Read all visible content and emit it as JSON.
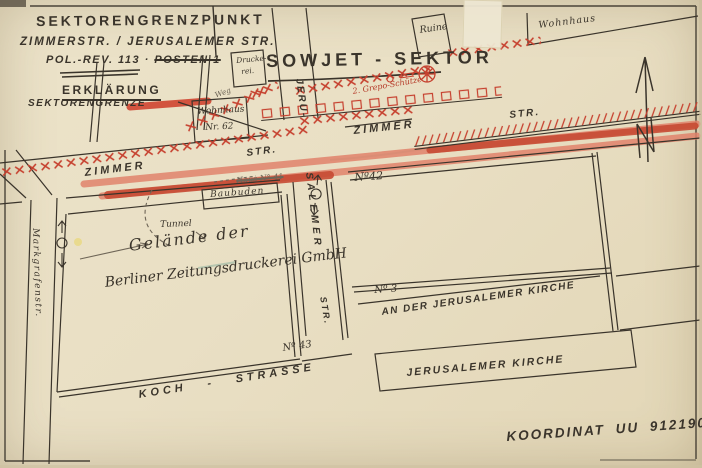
{
  "title": {
    "l1": "SEKTORENGRENZPUNKT",
    "l2": "ZIMMERSTR. / JERUSALEMER STR.",
    "l3a": "POL.-REV. 113 ·",
    "l3b": "POSTEN 1",
    "erklaerung": "ERKLÄRUNG",
    "legend": "SEKTORENGRENZE"
  },
  "banner": {
    "sowjet": "SOWJET - SEKTOR"
  },
  "streets": {
    "zimmer_w": "ZIMMER",
    "str_w": "STR.",
    "zimmer_e": "ZIMMER",
    "str_e": "STR.",
    "jeru": "JERU-",
    "salemer": "SALEMER",
    "str_v": "STR.",
    "markgrafen": "Markgrafenstr.",
    "koch": "KOCH -  STRASSE",
    "anderkirche": "AN DER JERUSALEMER KIRCHE"
  },
  "buildings": {
    "ruine": "Ruine",
    "wohnhaus_ne": "Wohnhaus",
    "wh62a": "Wohnhaus",
    "wh62b": "Nr. 62",
    "druck_a": "Drucke-",
    "druck_b": "rei.",
    "baubuden": "Baubuden",
    "haus41": "Haus N° 41",
    "gel1": "Gelände der",
    "gel2": "Berliner Zeitungsdruckerei GmbH",
    "kirche": "JERUSALEMER KIRCHE"
  },
  "numbers": {
    "n42": "Nº42",
    "n3": "Nº 3",
    "n43": "Nº 43"
  },
  "annot": {
    "weg": "Weg",
    "tunnel": "Tunnel",
    "grepo": "2. Grepo-Schütze",
    "koordinat": "KOORDINAT UU 912190"
  },
  "colors": {
    "ink": "#3a342b",
    "red": "#c6402e",
    "salmon": "#e0836b",
    "dark_red": "#c74a33",
    "paper": "#e9dfc4",
    "pencil": "#6e6557"
  }
}
